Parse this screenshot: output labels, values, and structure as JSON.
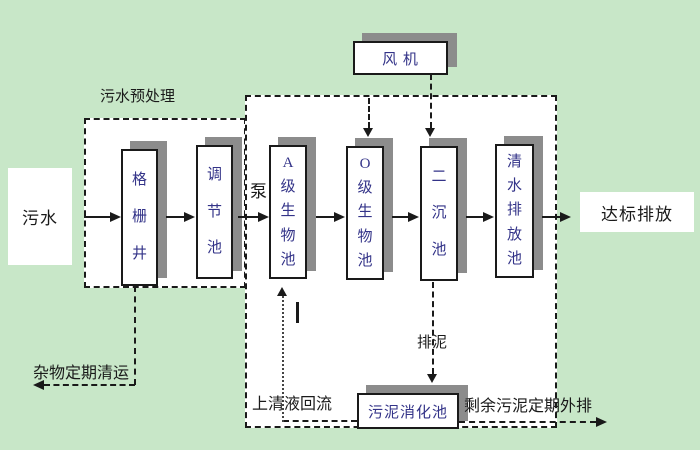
{
  "diagram": {
    "nodes": {
      "influent": "污水",
      "grid_well": "格栅井",
      "regulating_tank": "调节池",
      "pump": "泵",
      "a_bio_tank": "A级生物池",
      "o_bio_tank": "O级生物池",
      "secondary_clarifier": "二沉池",
      "clean_water_tank": "清水排放池",
      "compliant_discharge": "达标排放",
      "fan": "风 机",
      "sludge_digestion_tank": "污泥消化池"
    },
    "annotations": {
      "pretreatment": "污水预处理",
      "debris_removal": "杂物定期清运",
      "supernatant_return": "上清液回流",
      "sludge_out": "排泥",
      "excess_sludge_out": "剩余污泥定期外排"
    },
    "colors": {
      "bg_green": "#c8e7c8",
      "box_fill": "#ffffff",
      "shadow_gray": "#8c8c8c",
      "ink": "#1a1a1a",
      "box_text_blue": "#333388"
    }
  }
}
